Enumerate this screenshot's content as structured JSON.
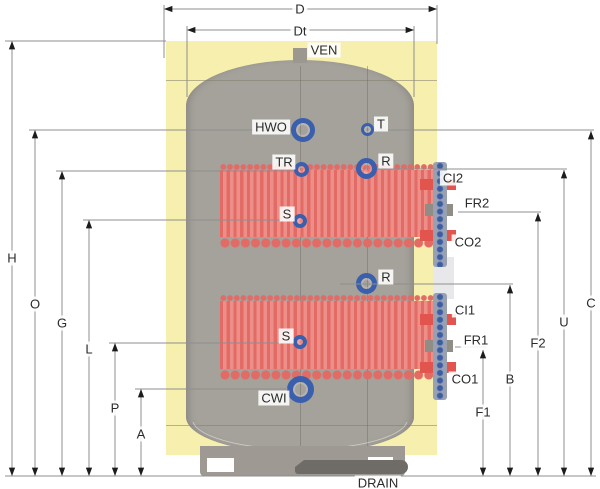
{
  "labels": {
    "d": "D",
    "dt": "Dt",
    "ven": "VEN",
    "hwo": "HWO",
    "t": "T",
    "tr": "TR",
    "r_upper": "R",
    "s_upper": "S",
    "ci2": "CI2",
    "fr2": "FR2",
    "co2": "CO2",
    "r_lower": "R",
    "ci1": "CI1",
    "fr1": "FR1",
    "co1": "CO1",
    "s_lower": "S",
    "cwi": "CWI",
    "drain": "DRAIN"
  },
  "dims": {
    "h": "H",
    "o": "O",
    "g": "G",
    "l": "L",
    "p": "P",
    "a": "A",
    "f1": "F1",
    "b": "B",
    "f2": "F2",
    "u": "U",
    "c": "C"
  },
  "colors": {
    "insulation": "#f6efad",
    "tank": "#a5a19b",
    "coil_light": "#ee8e88",
    "coil_dark": "#e26b66",
    "port_blue": "#3a5fad",
    "stub_red": "#e2544e",
    "dim_line": "#8f8f8f",
    "arrow": "#1c1c1c",
    "label_text": "#2b2b2b"
  }
}
